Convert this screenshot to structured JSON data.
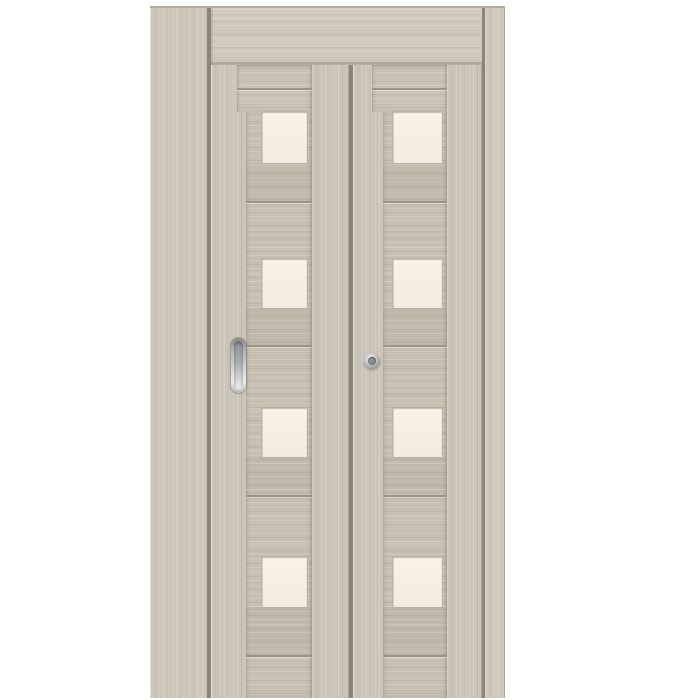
{
  "meta": {
    "subject": "interior bi-fold folding door product photo on white background",
    "leaf_count": 2,
    "glass_inserts_per_leaf": 4,
    "finish": "light cappuccino woodgrain",
    "glass": "frosted cream glass"
  },
  "door": {
    "parts": {
      "top_track": "wood-clad sliding track header",
      "left_strip": "narrow side track strip",
      "right_strip": "narrow side track strip",
      "left_leaf_hardware": "recessed oval pull handle",
      "right_leaf_hardware": "round chrome knob"
    }
  },
  "colors": {
    "background": "#ffffff",
    "top_edge": "#b2ab9e",
    "wood_stile": "#cbc4b8",
    "wood_strip": "#cdc6b9",
    "wood_strip_right": "#cfc8bb",
    "wood_panel": "#c6bfb2",
    "wood_header": "#cfc8bb",
    "wood_rail": "#c9c2b5",
    "seam_dark": "#8b8478",
    "seam_mid": "#9b9486",
    "glass_top": "#f8f2e9",
    "glass_bottom": "#f1ebe1",
    "glass_edge": "#b9b2a4",
    "metal_light": "#eceded",
    "metal_mid": "#b5b7b9",
    "metal_dark": "#87898c",
    "knob_center": "#77797c"
  }
}
